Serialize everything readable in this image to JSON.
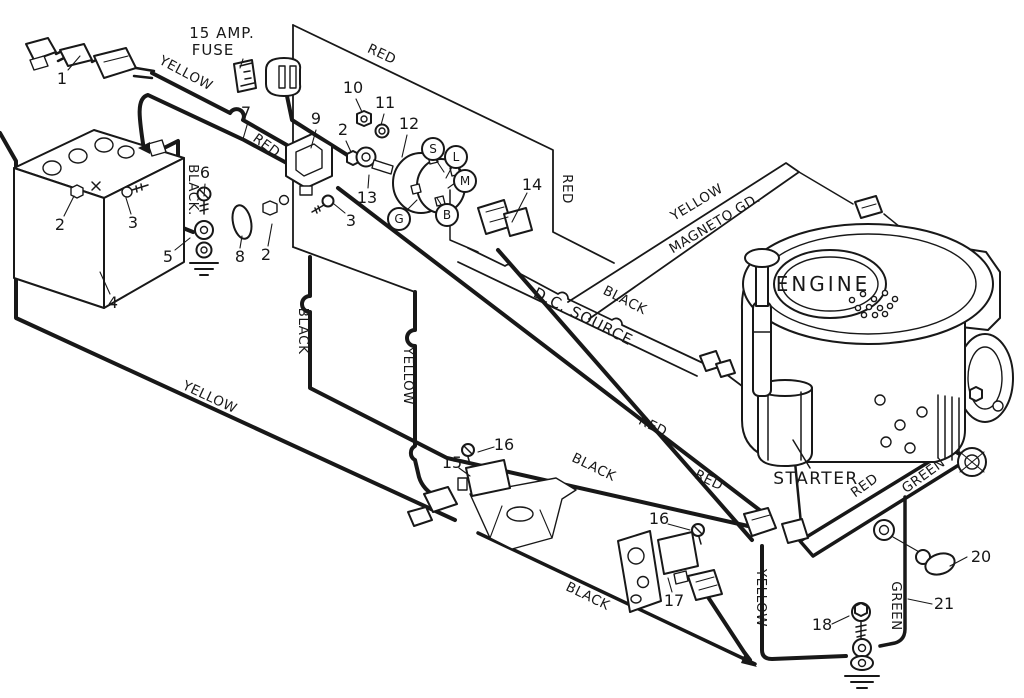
{
  "diagram": {
    "type": "wiring-diagram",
    "subject": "riding mower electrical wiring schematic"
  },
  "labels": {
    "fuse_line1": "15 AMP.",
    "fuse_line2": "FUSE",
    "yellow": "YELLOW",
    "red": "RED",
    "black": "BLACK",
    "black_dot": "BLACK.",
    "green": "GREEN",
    "dc_source": "D.C. SOURCE",
    "magneto": "MAGNETO GD.",
    "engine": "ENGINE",
    "starter": "STARTER"
  },
  "terminals": {
    "s": "S",
    "l": "L",
    "m": "M",
    "g": "G",
    "b": "B"
  },
  "callouts": {
    "n1": "1",
    "n2": "2",
    "n3": "3",
    "n4": "4",
    "n5": "5",
    "n6": "6",
    "n7": "7",
    "n8": "8",
    "n9": "9",
    "n10": "10",
    "n11": "11",
    "n12": "12",
    "n13": "13",
    "n14": "14",
    "n15": "15",
    "n16": "16",
    "n17": "17",
    "n18": "18",
    "n20": "20",
    "n21": "21"
  },
  "colors": {
    "ink": "#181818",
    "background": "#ffffff"
  }
}
